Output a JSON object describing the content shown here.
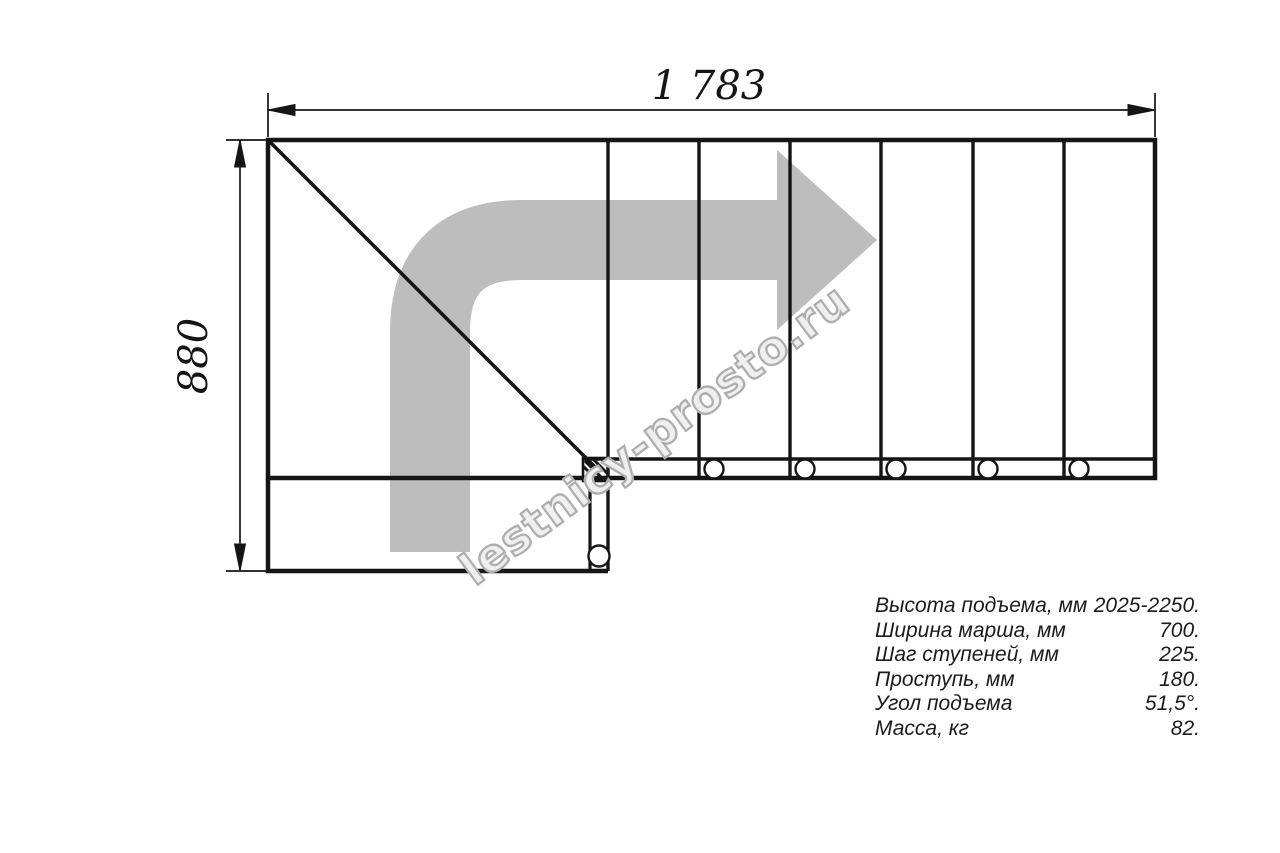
{
  "drawing": {
    "width_label": "1 783",
    "height_label": "880"
  },
  "watermark": {
    "text": "lestnicy-prosto.ru",
    "outline_color": "#aeaeae",
    "fill_color": "#ffffff"
  },
  "colors": {
    "arrow": "#bdbdbd",
    "line": "#151515"
  },
  "specs": {
    "rows": [
      {
        "label": "Высота подъема, мм",
        "value": "2025-2250."
      },
      {
        "label": "Ширина марша, мм",
        "value": "700."
      },
      {
        "label": "Шаг ступеней, мм",
        "value": "225."
      },
      {
        "label": "Проступь, мм",
        "value": "180."
      },
      {
        "label": "Угол подъема",
        "value": "51,5°."
      },
      {
        "label": "Масса, кг",
        "value": "82."
      }
    ]
  }
}
